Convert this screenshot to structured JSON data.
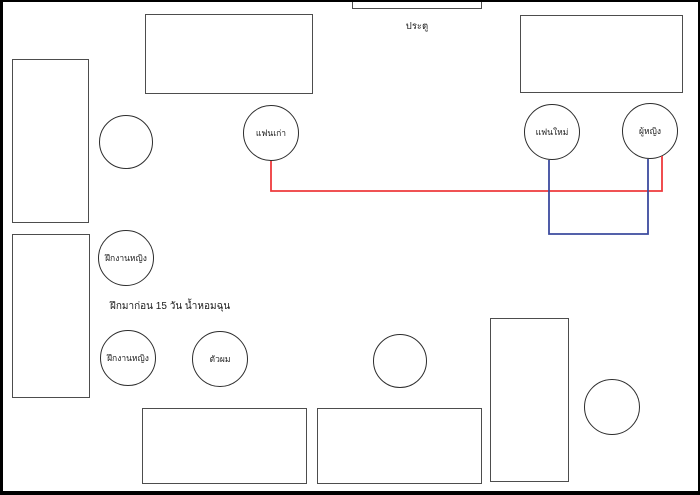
{
  "diagram": {
    "door_label": "ประตู",
    "note_text": "ฝึกมาก่อน 15 วัน น้ำหอมฉุน",
    "seats": {
      "ex_girlfriend": "แฟนเก่า",
      "new_girlfriend": "แฟนใหม่",
      "woman": "ผู้หญิง",
      "intern_upper": "ฝึกงานหญิง",
      "intern_lower": "ฝึกงานหญิง",
      "me": "ตัวผม"
    },
    "colors": {
      "red_line": "#ee3a3d",
      "blue_line": "#3c4b9e",
      "shape_stroke": "#4d4d4d",
      "circle_stroke": "#2d2d2d",
      "frame": "#000000"
    }
  }
}
